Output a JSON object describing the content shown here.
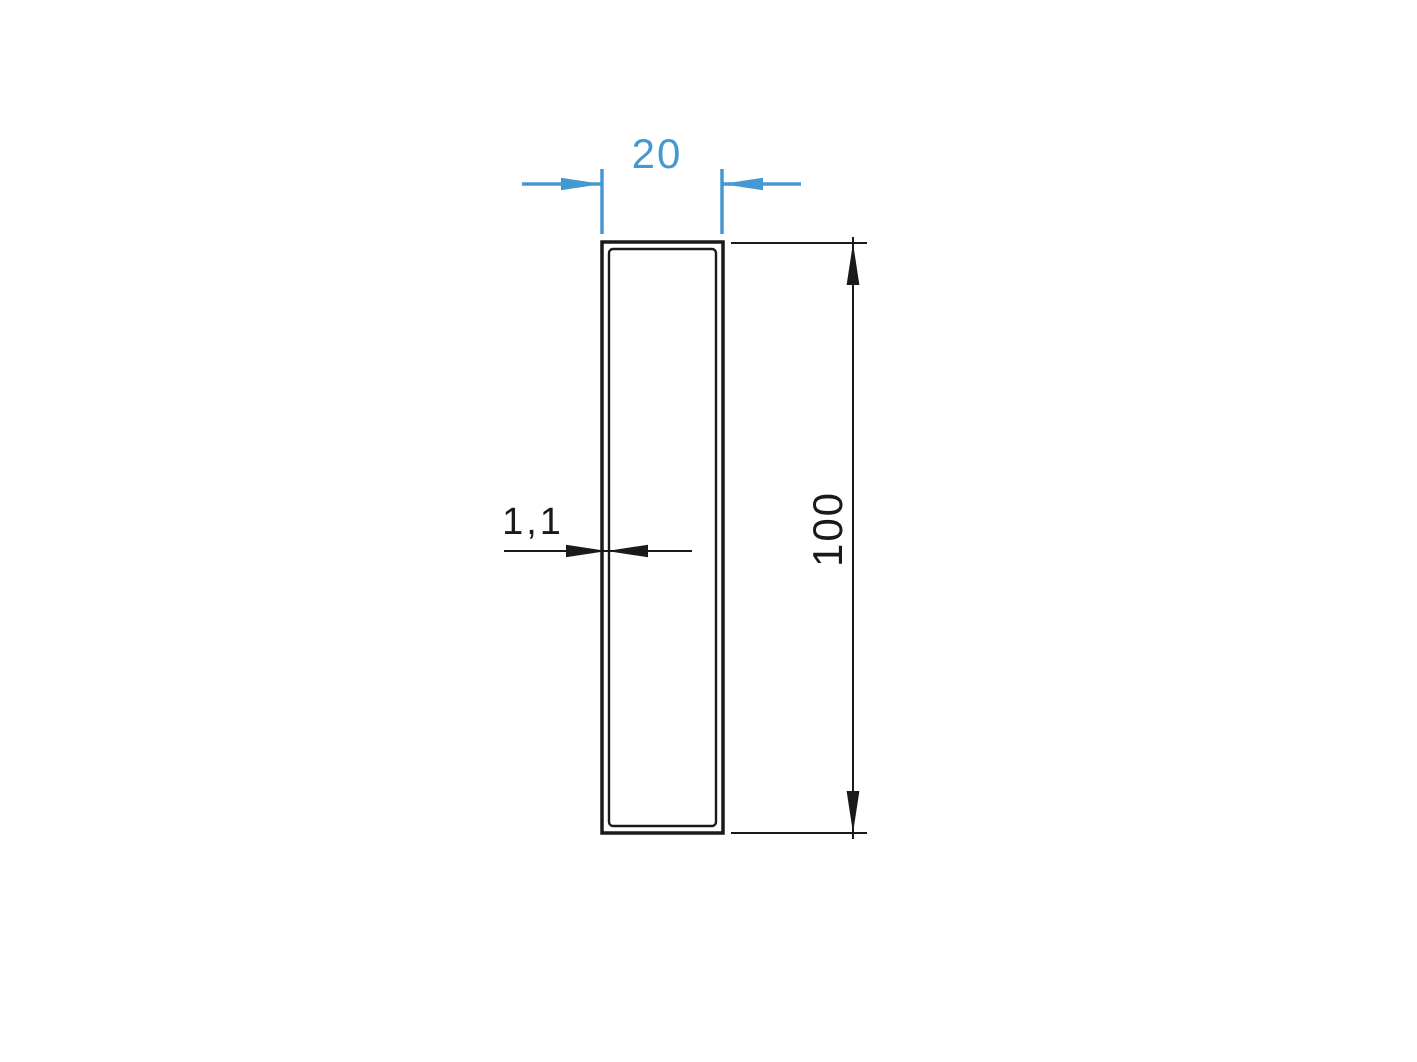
{
  "drawing": {
    "type": "technical-cross-section",
    "part": "rectangular-tube-profile",
    "dimensions": {
      "width": {
        "label": "20",
        "color": "#4499d2"
      },
      "height": {
        "label": "100",
        "color": "#1a1a1a"
      },
      "wall_thickness": {
        "label": "1,1",
        "color": "#1a1a1a"
      }
    },
    "profile": {
      "outer_width_mm": 20,
      "outer_height_mm": 100,
      "wall_thickness_mm": 1.1
    }
  },
  "colors": {
    "dim-blue": "#4499d2",
    "dim-black": "#1a1a1a",
    "background": "#ffffff"
  }
}
